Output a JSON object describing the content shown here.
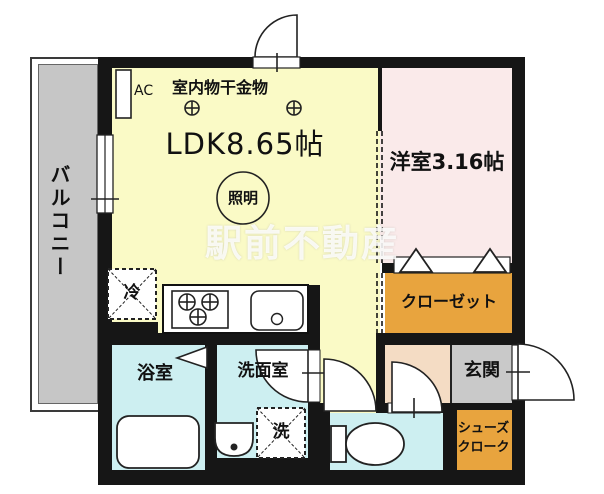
{
  "plan": {
    "watermark": "駅前不動産",
    "rooms": {
      "ldk": {
        "label": "LDK8.65帖"
      },
      "western_room": {
        "label": "洋室3.16帖"
      },
      "balcony": {
        "label": "バルコニー"
      },
      "bathroom": {
        "label": "浴室"
      },
      "washroom": {
        "label": "洗面室"
      },
      "entrance": {
        "label": "玄関"
      },
      "closet": {
        "label": "クローゼット"
      },
      "shoe_closet": {
        "label_line1": "シューズ",
        "label_line2": "クローク"
      }
    },
    "annotations": {
      "ac": "AC",
      "indoor_laundry_hardware": "室内物干金物",
      "lighting": "照明",
      "refrigerator": "冷",
      "washing_machine": "洗"
    },
    "colors": {
      "ldk": "#fafac6",
      "western_room": "#faeaea",
      "closet": "#e8a43e",
      "hall": "#f4dcc4",
      "entrance": "#c9c9c9",
      "balcony": "#c6c6c6",
      "wet_rooms": "#cdeff1",
      "wall": "#161616",
      "watermark_text": "#ffffff"
    }
  }
}
